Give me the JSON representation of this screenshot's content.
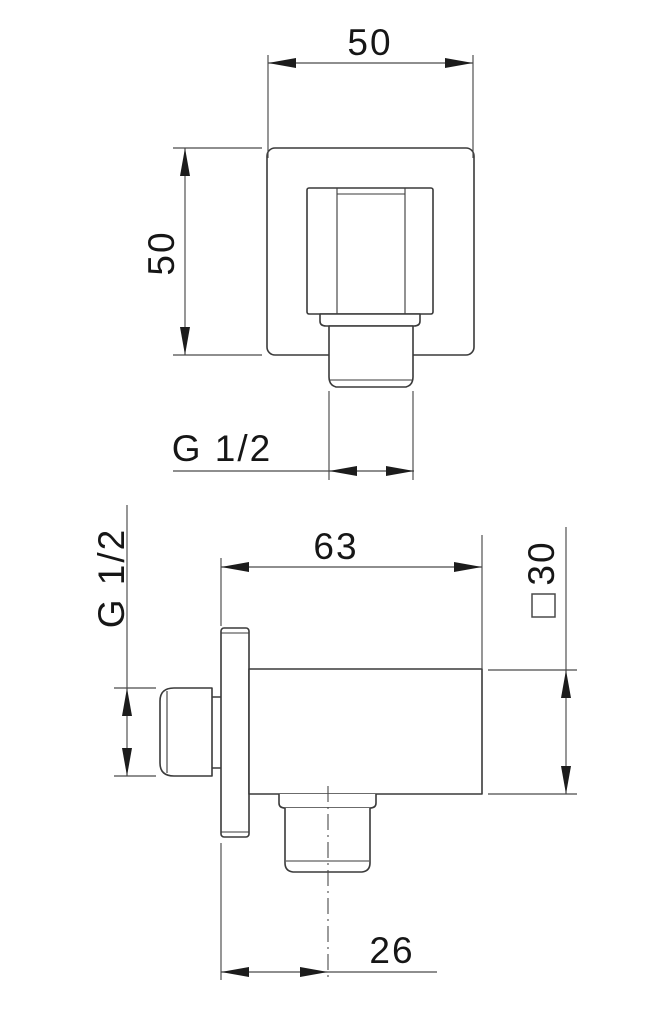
{
  "drawing": {
    "views": {
      "front": {
        "plate_width_mm": "50",
        "plate_height_mm": "50",
        "outlet_thread_label": "G 1/2"
      },
      "side": {
        "body_depth_mm": "63",
        "body_square_mm": "30",
        "square_section_symbol": "□",
        "inlet_thread_label": "G 1/2",
        "outlet_offset_mm": "26"
      }
    },
    "colors": {
      "background": "#ffffff",
      "object_line": "#3a3a3a",
      "dimension_line": "#4a4a4a",
      "text": "#161616"
    }
  }
}
